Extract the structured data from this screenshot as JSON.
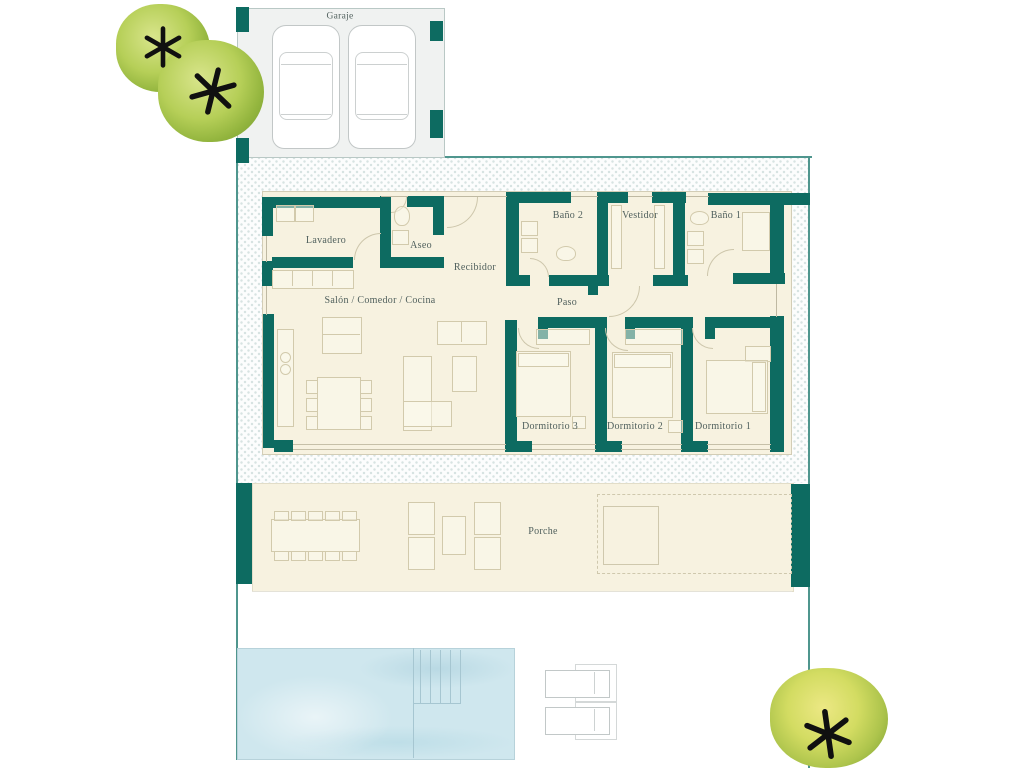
{
  "labels": {
    "garaje": "Garaje",
    "lavadero": "Lavadero",
    "aseo": "Aseo",
    "recibidor": "Recibidor",
    "salon": "Salón / Comedor / Cocina",
    "banio2": "Baño 2",
    "vestidor": "Vestidor",
    "banio1": "Baño 1",
    "paso": "Paso",
    "dormitorio3": "Dormitorio 3",
    "dormitorio2": "Dormitorio 2",
    "dormitorio1": "Dormitorio 1",
    "porche": "Porche"
  },
  "colors": {
    "wall": "#0d6b61",
    "floor": "#f7f2e0",
    "garage_floor": "#f0f2f1",
    "boundary": "#4f968e",
    "hatch_dot": "#d7e3e2",
    "pool": "#cfe7ee",
    "label_text": "#50605d",
    "furniture_line": "#d2caac"
  }
}
